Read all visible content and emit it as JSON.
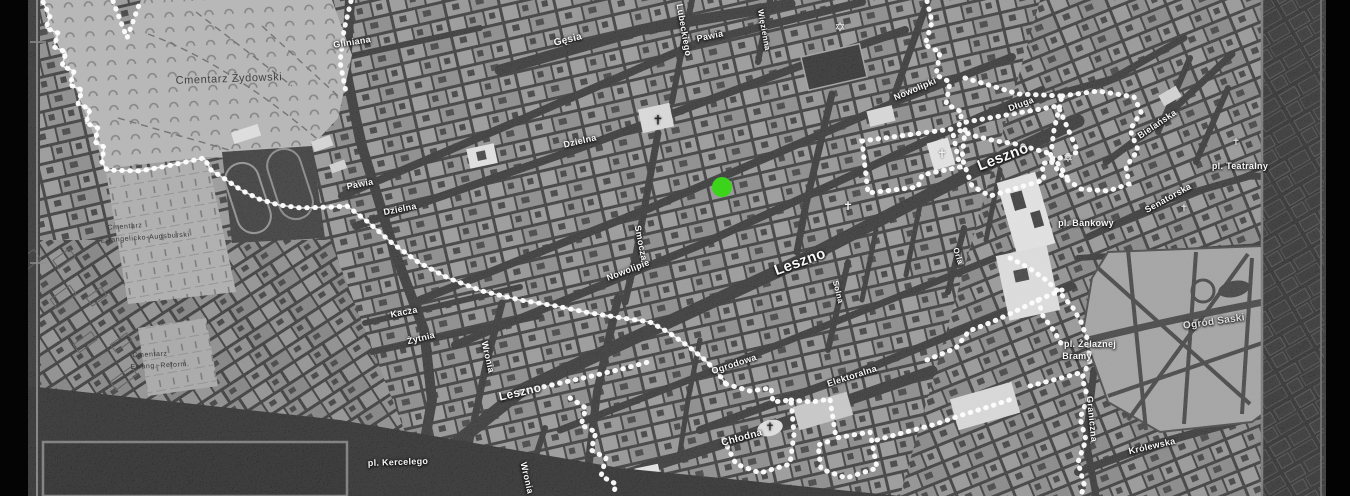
{
  "app": {
    "description": "Historical street map of the Warsaw Ghetto district with boundary and selected location",
    "background_color": "#000000"
  },
  "map": {
    "boundary": {
      "name": "ghetto-boundary",
      "color": "#ffffff",
      "style": "dotted"
    },
    "marker": {
      "name": "location-marker",
      "color": "#3bd41a",
      "x": 722,
      "y": 187,
      "diameter": 20
    },
    "areas": [
      {
        "name": "jewish-cemetery",
        "label": "Cmentarz Żydowski"
      },
      {
        "name": "evangelical-augsburg-cemetery",
        "label": "Cmentarz Ewangelicko-Augsburski"
      },
      {
        "name": "evangelical-reformed-cemetery",
        "label": "Cmentarz Ewang.-Reform."
      },
      {
        "name": "saxon-garden",
        "label": "Ogród Saski"
      }
    ],
    "labels": [
      {
        "name": "street-label-gliniana",
        "text": "Gliniana",
        "x": 352,
        "y": 42,
        "rot": -9,
        "size": 9
      },
      {
        "name": "street-label-gesia",
        "text": "Gęsia",
        "x": 568,
        "y": 40,
        "rot": -14,
        "size": 10
      },
      {
        "name": "street-label-lubeckiego",
        "text": "Lubeckiego",
        "x": 684,
        "y": 30,
        "rot": 80,
        "size": 9
      },
      {
        "name": "street-label-pawia-e",
        "text": "Pawia",
        "x": 710,
        "y": 36,
        "rot": -12,
        "size": 9
      },
      {
        "name": "street-label-wiezienna",
        "text": "Więzienna",
        "x": 764,
        "y": 30,
        "rot": 80,
        "size": 8
      },
      {
        "name": "street-label-pawia-w",
        "text": "Pawia",
        "x": 360,
        "y": 184,
        "rot": -11,
        "size": 9
      },
      {
        "name": "street-label-dzielna-w",
        "text": "Dzielna",
        "x": 400,
        "y": 209,
        "rot": -11,
        "size": 9
      },
      {
        "name": "street-label-dzielna-e",
        "text": "Dzielna",
        "x": 580,
        "y": 141,
        "rot": -13,
        "size": 9
      },
      {
        "name": "street-label-smocza",
        "text": "Smocza",
        "x": 641,
        "y": 243,
        "rot": 79,
        "size": 9
      },
      {
        "name": "street-label-nowolipie",
        "text": "Nowolipie",
        "x": 628,
        "y": 270,
        "rot": -21,
        "size": 9
      },
      {
        "name": "street-label-nowolipki",
        "text": "Nowolipki",
        "x": 915,
        "y": 89,
        "rot": -23,
        "size": 9
      },
      {
        "name": "street-label-leszno-mid",
        "text": "Leszno",
        "x": 800,
        "y": 262,
        "rot": -20,
        "size": 15
      },
      {
        "name": "street-label-leszno-e",
        "text": "Leszno",
        "x": 1003,
        "y": 157,
        "rot": -21,
        "size": 15
      },
      {
        "name": "street-label-leszno-w",
        "text": "Leszno",
        "x": 520,
        "y": 392,
        "rot": -13,
        "size": 12
      },
      {
        "name": "street-label-kacza",
        "text": "Kacza",
        "x": 404,
        "y": 312,
        "rot": -11,
        "size": 9
      },
      {
        "name": "street-label-zytnia",
        "text": "Żytnia",
        "x": 421,
        "y": 338,
        "rot": -14,
        "size": 9
      },
      {
        "name": "street-label-wronia-n",
        "text": "Wronia",
        "x": 488,
        "y": 357,
        "rot": 77,
        "size": 9
      },
      {
        "name": "street-label-wronia-s",
        "text": "Wronia",
        "x": 527,
        "y": 478,
        "rot": 77,
        "size": 9
      },
      {
        "name": "place-label-kercelego",
        "text": "pl. Kercelego",
        "x": 398,
        "y": 462,
        "rot": -2,
        "size": 9
      },
      {
        "name": "street-label-ogrodowa",
        "text": "Ogrodowa",
        "x": 734,
        "y": 364,
        "rot": -18,
        "size": 9
      },
      {
        "name": "street-label-elektoralna",
        "text": "Elektoralna",
        "x": 852,
        "y": 376,
        "rot": -18,
        "size": 9
      },
      {
        "name": "street-label-chlodna",
        "text": "Chłodna",
        "x": 742,
        "y": 438,
        "rot": -15,
        "size": 10
      },
      {
        "name": "street-label-solna",
        "text": "Solna",
        "x": 838,
        "y": 292,
        "rot": 76,
        "size": 8
      },
      {
        "name": "street-label-orla",
        "text": "Orla",
        "x": 958,
        "y": 256,
        "rot": 72,
        "size": 8
      },
      {
        "name": "street-label-dluga",
        "text": "Długa",
        "x": 1021,
        "y": 104,
        "rot": -21,
        "size": 9
      },
      {
        "name": "street-label-bielanska",
        "text": "Bielańska",
        "x": 1157,
        "y": 124,
        "rot": -34,
        "size": 9
      },
      {
        "name": "street-label-senatorska",
        "text": "Senatorska",
        "x": 1168,
        "y": 198,
        "rot": -29,
        "size": 9
      },
      {
        "name": "place-label-teatralny",
        "text": "pl. Teatralny",
        "x": 1240,
        "y": 166,
        "rot": 0,
        "size": 9
      },
      {
        "name": "place-label-bankowy",
        "text": "pl. Bankowy",
        "x": 1086,
        "y": 223,
        "rot": 0,
        "size": 9
      },
      {
        "name": "place-label-zelaznej-1",
        "text": "pl. Żelaznej",
        "x": 1090,
        "y": 344,
        "rot": 0,
        "size": 9
      },
      {
        "name": "place-label-zelaznej-2",
        "text": "Bramy",
        "x": 1077,
        "y": 356,
        "rot": 0,
        "size": 9
      },
      {
        "name": "street-label-graniczna",
        "text": "Graniczna",
        "x": 1092,
        "y": 419,
        "rot": 84,
        "size": 9
      },
      {
        "name": "street-label-krolewska",
        "text": "Królewska",
        "x": 1152,
        "y": 446,
        "rot": -13,
        "size": 9
      },
      {
        "name": "area-label-saski",
        "text": "Ogród Saski",
        "x": 1214,
        "y": 322,
        "rot": -8,
        "size": 10,
        "color": "#dedede"
      },
      {
        "name": "area-label-jewish-cemetery",
        "text": "Cmentarz Żydowski",
        "x": 229,
        "y": 79,
        "rot": -2,
        "size": 11,
        "color": "#3f3f3f",
        "dark": true
      },
      {
        "name": "area-label-ev-augsburg-1",
        "text": "Cmentarz",
        "x": 125,
        "y": 227,
        "rot": -4,
        "size": 7,
        "color": "#383838",
        "dark": true
      },
      {
        "name": "area-label-ev-augsburg-2",
        "text": "Ewangelicko-Augsburski",
        "x": 145,
        "y": 238,
        "rot": -4,
        "size": 7,
        "color": "#383838",
        "dark": true
      },
      {
        "name": "area-label-ev-reform-1",
        "text": "Cmentarz",
        "x": 150,
        "y": 355,
        "rot": -3,
        "size": 7,
        "color": "#383838",
        "dark": true
      },
      {
        "name": "area-label-ev-reform-2",
        "text": "Ewang.-Reform.",
        "x": 160,
        "y": 366,
        "rot": -3,
        "size": 7,
        "color": "#383838",
        "dark": true
      }
    ],
    "icons": [
      {
        "name": "star-of-david-icon",
        "glyph": "✡",
        "x": 840,
        "y": 27,
        "size": 13,
        "color": "#f2f2f2"
      },
      {
        "name": "star-of-david-icon",
        "glyph": "✡",
        "x": 1068,
        "y": 158,
        "size": 12,
        "color": "#e8e8e8"
      },
      {
        "name": "church-cross-icon",
        "glyph": "✝",
        "x": 658,
        "y": 120,
        "size": 13,
        "color": "#2a2a2a"
      },
      {
        "name": "church-cross-icon",
        "glyph": "✝",
        "x": 848,
        "y": 206,
        "size": 12,
        "color": "#f0f0f0"
      },
      {
        "name": "church-cross-icon",
        "glyph": "✝",
        "x": 942,
        "y": 154,
        "size": 12,
        "color": "#f0f0f0"
      },
      {
        "name": "church-cross-icon",
        "glyph": "✝",
        "x": 770,
        "y": 428,
        "size": 11,
        "color": "#2a2a2a"
      },
      {
        "name": "church-cross-icon",
        "glyph": "✝",
        "x": 1236,
        "y": 143,
        "size": 10,
        "color": "#dddddd"
      },
      {
        "name": "church-cross-icon",
        "glyph": "✝",
        "x": 1184,
        "y": 209,
        "size": 10,
        "color": "#dddddd"
      }
    ]
  }
}
